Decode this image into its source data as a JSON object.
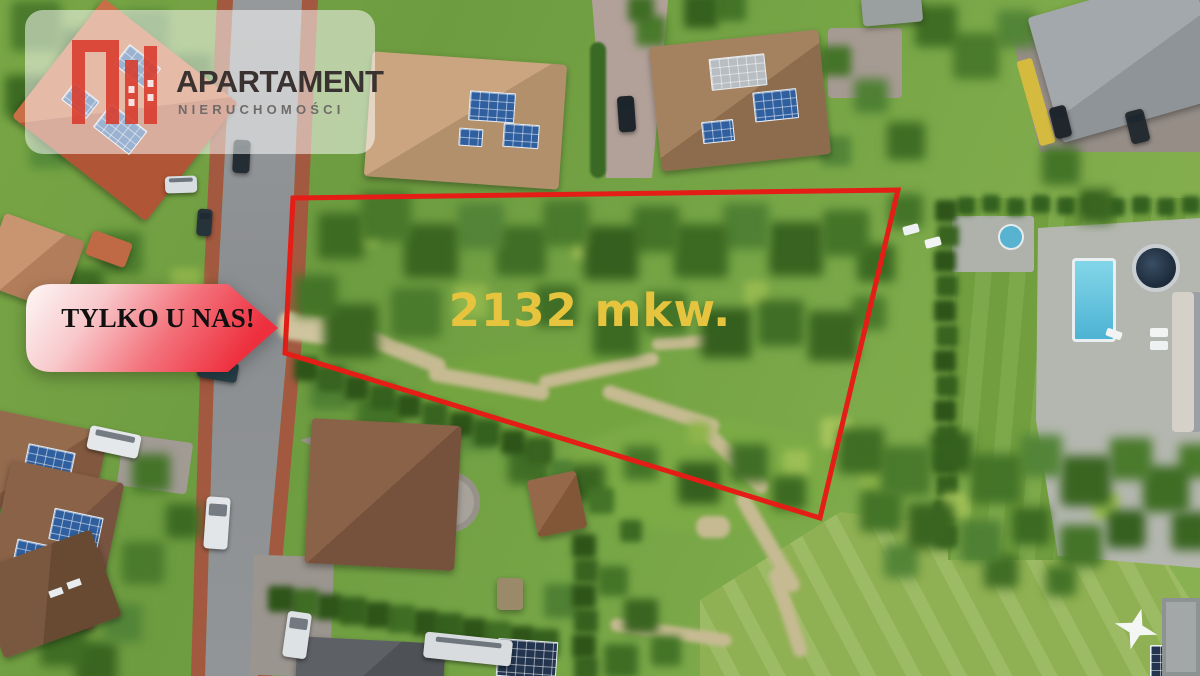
{
  "brand": {
    "name": "APARTAMENT",
    "tagline": "NIERUCHOMOŚCI",
    "logo_red": "#d93a2b",
    "title_color": "#3a3230",
    "subtitle_color": "#6f6b69"
  },
  "banner": {
    "label": "TYLKO U NAS!",
    "text_color": "#101010",
    "gradient_start": "#fdf8f6",
    "gradient_end": "#ee2f3e"
  },
  "plot": {
    "area_label": "2132 mkw.",
    "label_color": "#e7c43e",
    "outline_color": "#e41d17",
    "outline_points": "293,198 898,190 820,518 285,353",
    "outline_stroke_width": "5"
  }
}
